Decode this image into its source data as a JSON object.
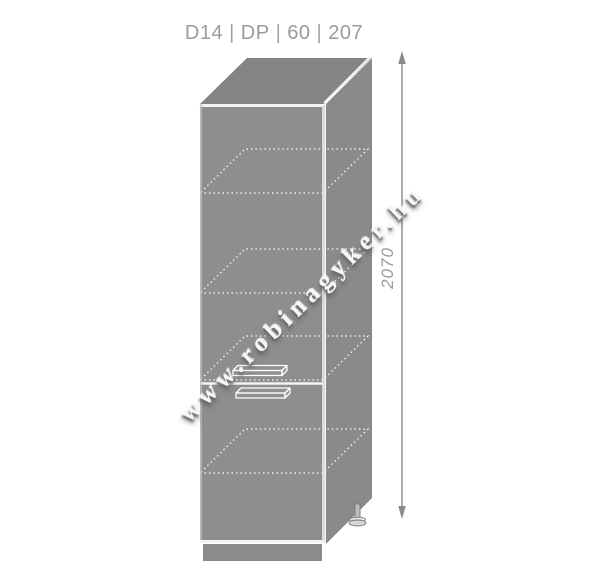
{
  "header": {
    "segments": [
      "D14",
      "DP",
      "60",
      "207"
    ],
    "separator": "|"
  },
  "drawing": {
    "dimension_height": "2070",
    "watermark": "www.robinagyker.hu",
    "shelf_count": 4,
    "door_count": 2
  },
  "colors": {
    "background": "#ffffff",
    "cabinet_front": "#8e8e8e",
    "cabinet_top": "#848484",
    "cabinet_side": "#8a8a8a",
    "plinth": "#8b8b8b",
    "edge_highlight": "#f4f4f4",
    "shelf_dotted": "#ffffff",
    "dimension_line": "#8a8a8a",
    "title_text": "#9b9b9b",
    "dimension_text": "#9a9a9a"
  }
}
